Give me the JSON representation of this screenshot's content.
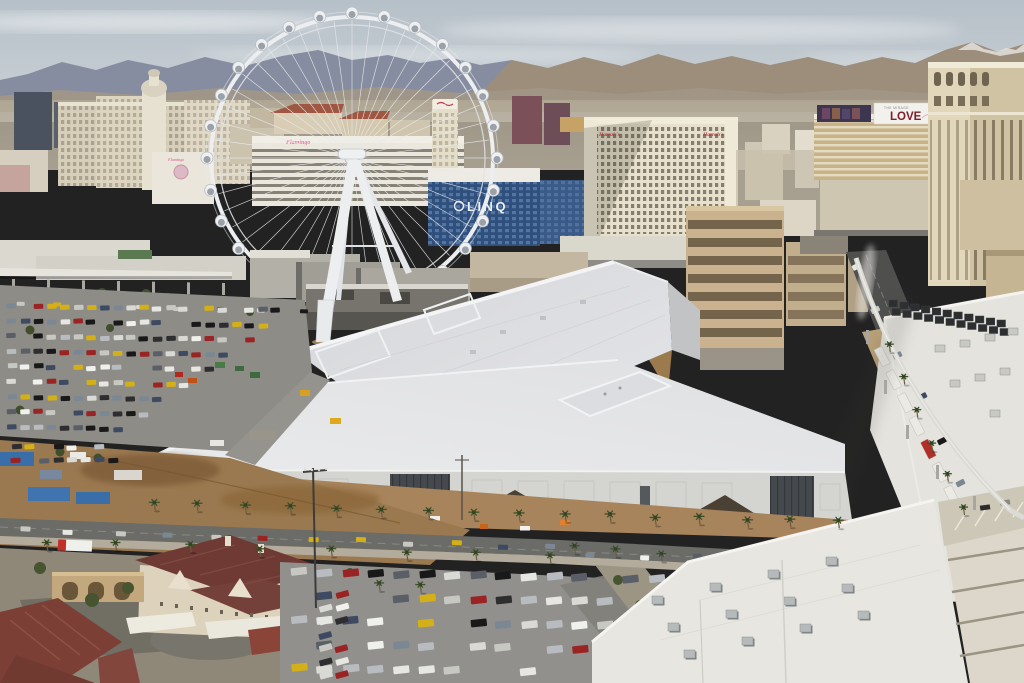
{
  "scene": {
    "type": "aerial-photograph",
    "signs": {
      "linq": "LINQ",
      "harrahs_left": "Harrah's",
      "harrahs_right": "Harrah's",
      "the_mirage": "THE MIRAGE",
      "love": "LOVE",
      "flamingo_roof": "Flamingo",
      "flamingo_wall": "Flamingo"
    },
    "colors": {
      "sky_top": "#b6c0c8",
      "sky_bottom": "#ccd3d7",
      "mountains_left": "#878da0",
      "mountains_right": "#9c8e7b",
      "haze": "#b1a895",
      "convention_roof": "#e4e5e8",
      "convention_wall": "#d4d5d1",
      "dirt": "#a07a4e",
      "asphalt": "#6b6b67",
      "linq_blue": "#2f4f7d",
      "harrahs_cream": "#e7e0cd",
      "mirage_gold": "#c8b388",
      "venetian_tan": "#d0c3a3",
      "love_red": "#7c202c",
      "flamingo_pink": "#e080a4",
      "harrahs_sign_red": "#b23a3e",
      "apartment_roof": "#6e3a33",
      "tile_roof": "#7c3f36",
      "palm_green": "#3e5029",
      "container_blue": "#3a6ea8"
    },
    "decorations": {
      "wheel": {
        "cx": 352,
        "cy": 158,
        "r": 141,
        "pods": 28,
        "pod_r": 6,
        "spokes": 48
      },
      "car_palette": [
        "#f0f0ec",
        "#e6e6e2",
        "#d9d9d5",
        "#2e2e30",
        "#5a5e66",
        "#b8bcc0",
        "#9a2424",
        "#7b8894",
        "#3e4a62",
        "#c8c8c2",
        "#191919",
        "#d4b018"
      ],
      "lots": [
        {
          "x": 6,
          "y": 302,
          "rows": 9,
          "cols": 22,
          "dx": 13.2,
          "dy": 15.2,
          "w": 9.5,
          "h": 5,
          "rot": -2,
          "trim": 1.6,
          "gap": 0.15,
          "coldy": 0.25
        },
        {
          "x": 10,
          "y": 444,
          "rows": 2,
          "cols": 8,
          "dx": 14,
          "dy": 13,
          "w": 10,
          "h": 5,
          "rot": -3,
          "trim": 0,
          "gap": 0.2,
          "coldy": 0
        },
        {
          "x": 290,
          "y": 568,
          "rows": 5,
          "cols": 17,
          "dx": 25.5,
          "dy": 24,
          "w": 16,
          "h": 7.5,
          "rot": -6,
          "trim": 0.5,
          "gap": 0.18,
          "coldy": 0.5
        },
        {
          "x": 318,
          "y": 592,
          "rows": 7,
          "cols": 2,
          "dx": 16,
          "dy": 13.5,
          "w": 13,
          "h": 6,
          "rot": -15,
          "trim": 0,
          "gap": 0.1,
          "coldy": 0
        }
      ],
      "traffic": [
        {
          "x1": 14,
          "y1": 524,
          "x2": 540,
          "y2": 543,
          "n": 12,
          "w": 10,
          "h": 5
        },
        {
          "x1": 580,
          "y1": 549,
          "x2": 845,
          "y2": 560,
          "n": 6,
          "w": 9,
          "h": 5
        },
        {
          "x1": 854,
          "y1": 262,
          "x2": 985,
          "y2": 520,
          "n": 7,
          "w": 5.5,
          "h": 9
        },
        {
          "x1": 10,
          "y1": 300,
          "x2": 295,
          "y2": 307,
          "n": 8,
          "w": 8,
          "h": 4
        }
      ],
      "palm_rows": [
        {
          "x1": 152,
          "y1": 508,
          "x2": 836,
          "y2": 528,
          "n": 16,
          "r": 5.5
        },
        {
          "x1": 44,
          "y1": 548,
          "x2": 548,
          "y2": 562,
          "n": 8,
          "r": 5
        },
        {
          "x1": 888,
          "y1": 352,
          "x2": 962,
          "y2": 514,
          "n": 6,
          "r": 4.5
        },
        {
          "x1": 572,
          "y1": 552,
          "x2": 660,
          "y2": 560,
          "n": 3,
          "r": 5
        },
        {
          "x1": 380,
          "y1": 588,
          "x2": 420,
          "y2": 592,
          "n": 2,
          "r": 5
        }
      ],
      "roof_units": {
        "ox": 652,
        "oy": 596,
        "ux": 58,
        "uy": -13,
        "vx": 16,
        "vy": 27,
        "cols": 4,
        "rows": 3,
        "w": 11,
        "h": 8
      },
      "east_units": {
        "x": 889,
        "y": 300,
        "n": 11,
        "dx": 10.8,
        "dy": 2.0,
        "w": 8.5,
        "h": 7,
        "rdx": 3,
        "rdy": 8.5
      },
      "truck_row": {
        "x1": 874,
        "y1": 350,
        "x2": 955,
        "y2": 512,
        "n": 8,
        "w": 8.5,
        "h": 19,
        "rot": -27
      },
      "guideway_cols": {
        "x1": 12,
        "y1": 279,
        "x2": 222,
        "y2": 283,
        "n": 7,
        "w": 3,
        "h": 12
      }
    }
  }
}
